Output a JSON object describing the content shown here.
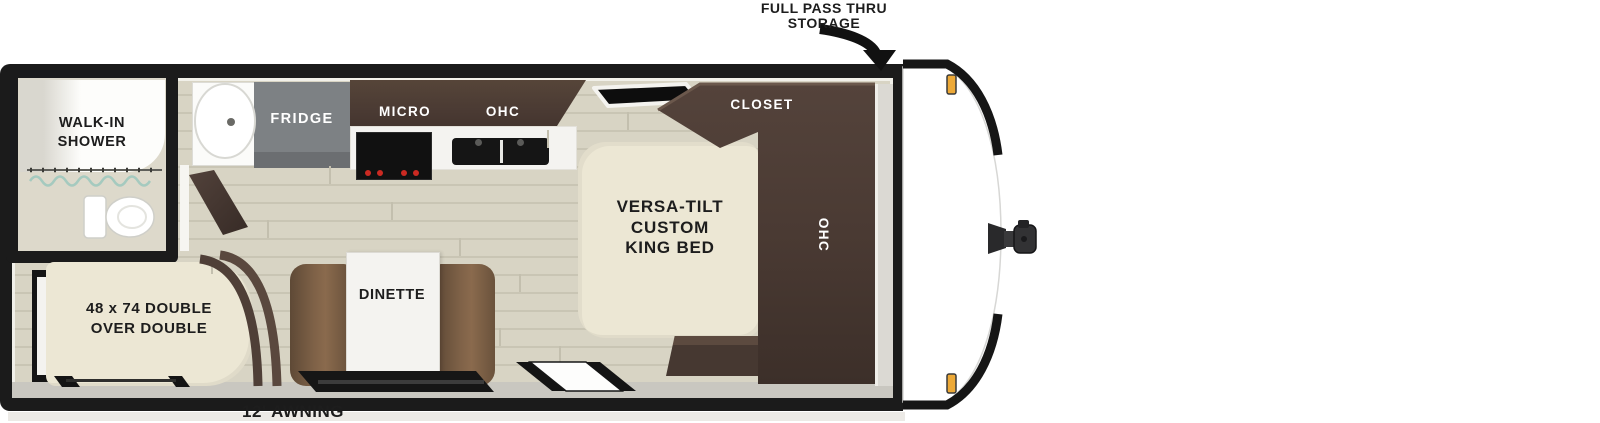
{
  "title": "Travel trailer floorplan",
  "labels": {
    "pass_thru": {
      "line1": "FULL PASS THRU",
      "line2": "STORAGE"
    },
    "shower": {
      "line1": "WALK-IN",
      "line2": "SHOWER"
    },
    "fridge": "FRIDGE",
    "micro": "MICRO",
    "kitchen_ohc": "OHC",
    "closet": "CLOSET",
    "bedroom_ohc": "OHC",
    "bed": {
      "line1": "VERSA-TILT",
      "line2": "CUSTOM",
      "line3": "KING BED"
    },
    "bunk": {
      "line1": "48 x 74 DOUBLE",
      "line2": "OVER DOUBLE"
    },
    "dinette": "DINETTE",
    "awning": "12' AWNING"
  },
  "colors": {
    "wall": "#1b1b1b",
    "floor": "#d8d4c4",
    "floor_line": "#c9c5b4",
    "walkway": "#c9c7c0",
    "bath_floor": "#ddd9cb",
    "cabinet": "#4a3a33",
    "cabinet_dark": "#3f312b",
    "cabinet_light": "#5c4a3f",
    "bench": "#7e6147",
    "bench_dark": "#5e4936",
    "fridge": "#7d8184",
    "cream": "#ece7d4",
    "white_surface": "#f4f3f0",
    "red": "#cc2a22",
    "amber": "#eda937",
    "teal": "#9fc8be",
    "awning": "#eceae6"
  }
}
